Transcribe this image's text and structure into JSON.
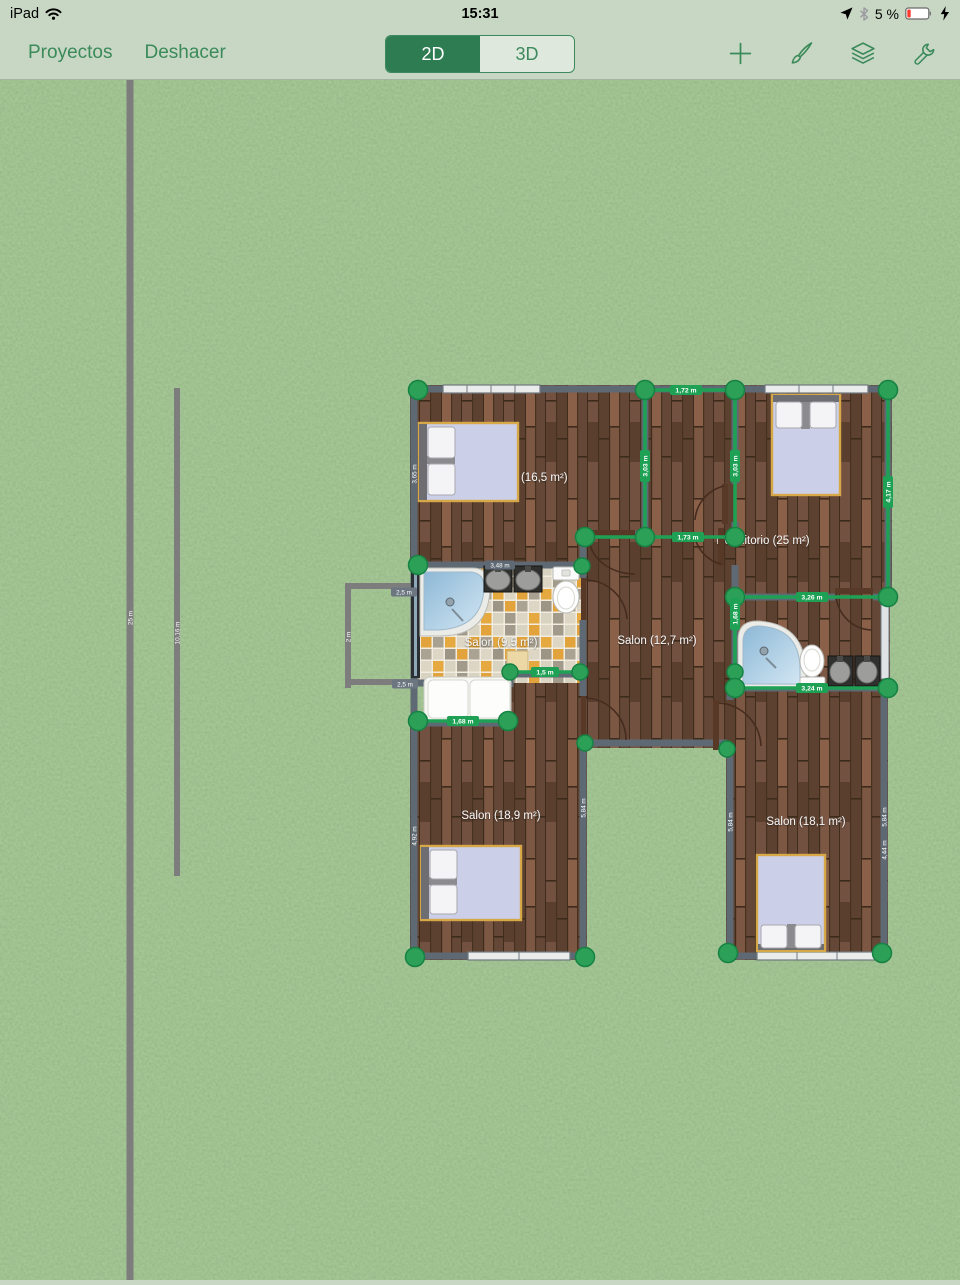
{
  "status_bar": {
    "device": "iPad",
    "time": "15:31",
    "battery_percent": "5 %"
  },
  "toolbar": {
    "projects": "Proyectos",
    "undo": "Deshacer",
    "mode_2d": "2D",
    "mode_3d": "3D"
  },
  "plan": {
    "rooms": [
      {
        "label": "Salon (16,5 m²)"
      },
      {
        "label": "Dormitorio (25 m²)"
      },
      {
        "label": "Salon (9,5 m²)"
      },
      {
        "label": "Salon (12,7 m²)"
      },
      {
        "label": "Salon (18,9 m²)"
      },
      {
        "label": "Salon (18,1 m²)"
      }
    ],
    "selection_measurements": [
      {
        "text": "1,72 m"
      },
      {
        "text": "3,03 m"
      },
      {
        "text": "3,03 m"
      },
      {
        "text": "4,17 m"
      },
      {
        "text": "1,73 m"
      },
      {
        "text": "3,26 m"
      },
      {
        "text": "1,68 m"
      },
      {
        "text": "3,24 m"
      },
      {
        "text": "1,5 m"
      },
      {
        "text": "1,68 m"
      }
    ],
    "wall_measurements": [
      {
        "text": "3,48 m"
      },
      {
        "text": "2,5 m"
      },
      {
        "text": "2,5 m"
      },
      {
        "text": "3,65 m"
      },
      {
        "text": "4,92 m"
      },
      {
        "text": "5,84 m"
      },
      {
        "text": "5,84 m"
      },
      {
        "text": "5,84 m"
      },
      {
        "text": "4,44 m"
      },
      {
        "text": "2 m"
      },
      {
        "text": "25 m"
      },
      {
        "text": "10,16 m"
      }
    ]
  },
  "colors": {
    "accent_green": "#2e7d52",
    "selection_green": "#1ea155",
    "toolbar_bg": "#c8d7c4",
    "wall_gray": "#5e6973",
    "battery_red": "#ff3b30"
  }
}
